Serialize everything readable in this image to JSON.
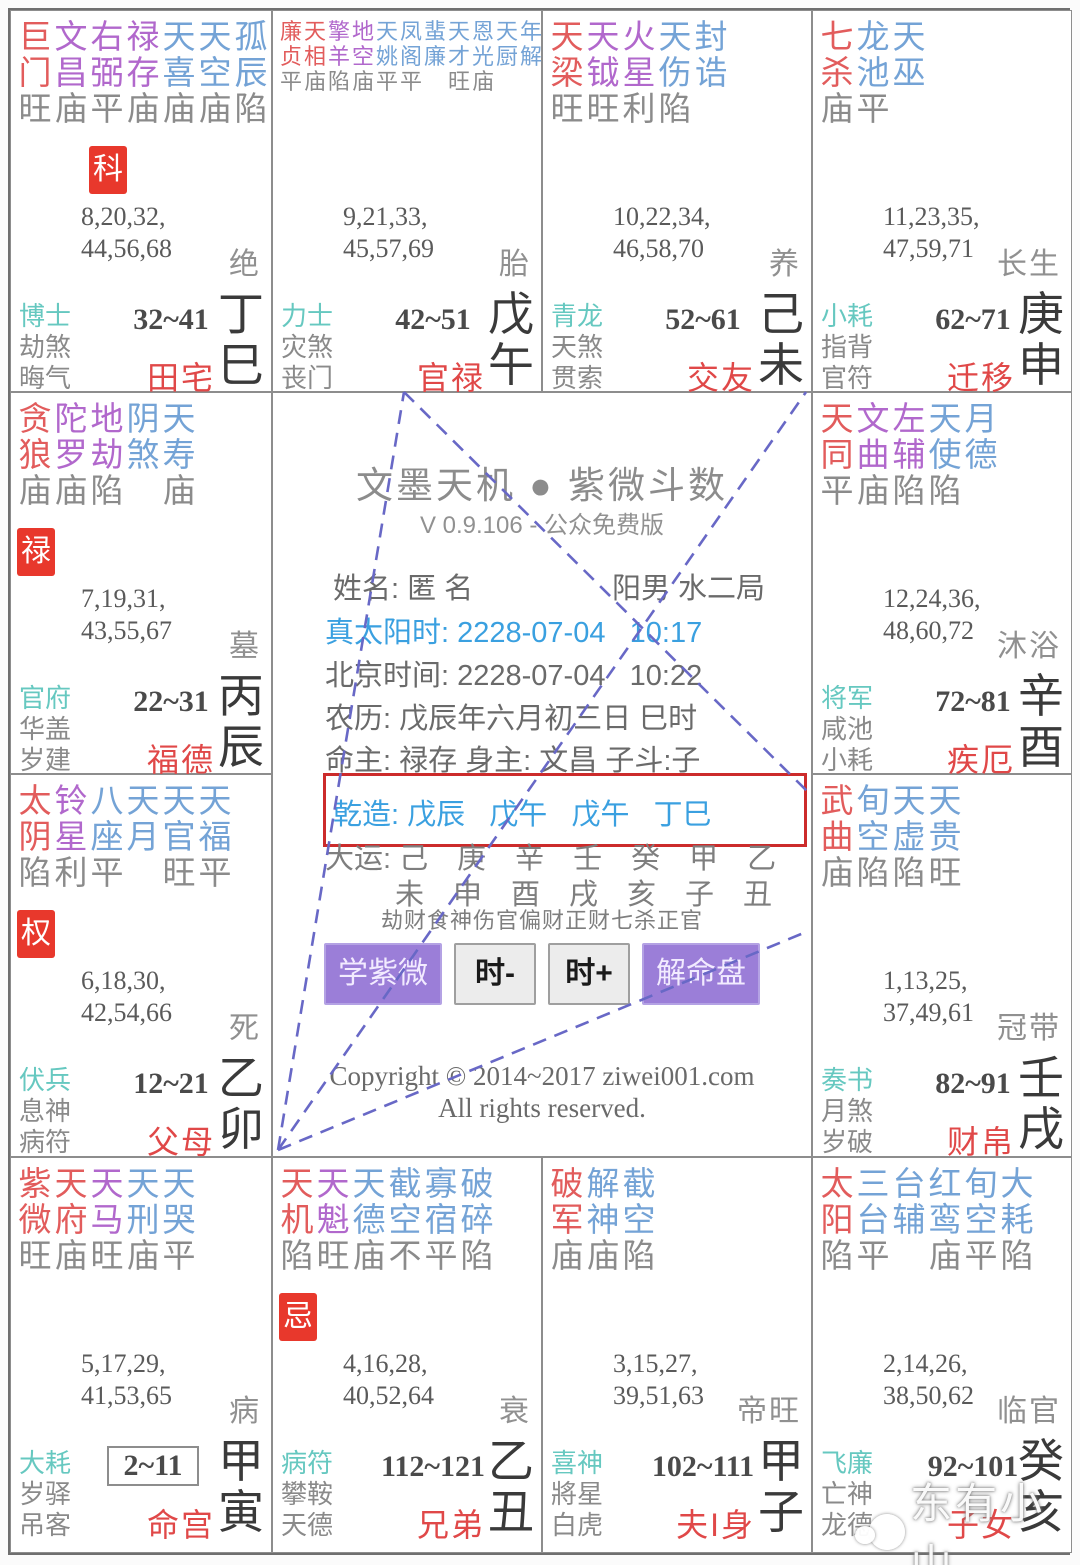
{
  "app": {
    "title": "文墨天机 ● 紫微斗数",
    "version": "V 0.9.106 - 公众免费版",
    "name_line": "姓名: 匿 名",
    "gender_bureau": "阳男 水二局",
    "true_solar_time": "真太阳时: 2228-07-04   10:17",
    "beijing_time": "北京时间: 2228-07-04   10:22",
    "lunar_date": "农历: 戊辰年六月初三日 巳时",
    "masters": "命主: 禄存 身主: 文昌 子斗:子",
    "qianzao": "乾造: 戊辰   戊午   戊午   丁巳",
    "dayun_stems": "大运: 己　庚　辛　壬　癸　甲　乙",
    "dayun_branches": "未　申　酉　戌　亥　子　丑",
    "ten_gods": "劫财食神伤官偏财正财七杀正官",
    "copyright_line1": "Copyright © 2014~2017 ziwei001.com",
    "copyright_line2": "All rights reserved.",
    "watermark": "东有小山",
    "accent_colors": {
      "major_star": "#e25c5c",
      "assist_star": "#b168cc",
      "minor_star": "#74a3d6",
      "badge_bg": "#e8382c",
      "palace_name": "#e04848",
      "god_teal": "#66c8c0",
      "highlight_box": "#cc2b2b",
      "time_blue": "#3aa0e0",
      "button_purple": "#9b7ed8",
      "dash_line": "#6868c6"
    },
    "buttons": [
      {
        "label": "学紫微",
        "kind": "purple"
      },
      {
        "label": "时-",
        "kind": "gray"
      },
      {
        "label": "时+",
        "kind": "gray"
      },
      {
        "label": "解命盘",
        "kind": "purple"
      }
    ]
  },
  "palaces": [
    {
      "slot": "r1c1",
      "branch_id": "si",
      "stars": [
        {
          "n": "巨门",
          "t": "m",
          "s": "旺"
        },
        {
          "n": "文昌",
          "t": "a",
          "s": "庙"
        },
        {
          "n": "右弼",
          "t": "a",
          "s": "平"
        },
        {
          "n": "禄存",
          "t": "a",
          "s": "庙"
        },
        {
          "n": "天喜",
          "t": "n",
          "s": "庙"
        },
        {
          "n": "天空",
          "t": "n",
          "s": "庙"
        },
        {
          "n": "孤辰",
          "t": "n",
          "s": "陷"
        }
      ],
      "badge": "科",
      "badge_col": 2,
      "ages1": "8,20,32,",
      "ages2": "44,56,68",
      "state": "绝",
      "gods": [
        "博士",
        "劫煞",
        "晦气"
      ],
      "range": "32~41",
      "boxed": false,
      "palace": "田宅",
      "stem": "丁",
      "branch": "巳"
    },
    {
      "slot": "r1c2",
      "branch_id": "wu",
      "stars": [
        {
          "n": "廉贞",
          "t": "m",
          "s": "平"
        },
        {
          "n": "天相",
          "t": "m",
          "s": "庙"
        },
        {
          "n": "擎羊",
          "t": "a",
          "s": "陷"
        },
        {
          "n": "地空",
          "t": "a",
          "s": "庙"
        },
        {
          "n": "天姚",
          "t": "n",
          "s": "平"
        },
        {
          "n": "凤阁",
          "t": "n",
          "s": "平"
        },
        {
          "n": "蜚廉",
          "t": "n",
          "s": ""
        },
        {
          "n": "天才",
          "t": "n",
          "s": "旺"
        },
        {
          "n": "恩光",
          "t": "n",
          "s": "庙"
        },
        {
          "n": "天厨",
          "t": "n",
          "s": ""
        },
        {
          "n": "年解",
          "t": "n",
          "s": ""
        }
      ],
      "badge": "",
      "badge_col": 0,
      "ages1": "9,21,33,",
      "ages2": "45,57,69",
      "state": "胎",
      "gods": [
        "力士",
        "灾煞",
        "丧门"
      ],
      "range": "42~51",
      "boxed": false,
      "palace": "官禄",
      "stem": "戊",
      "branch": "午"
    },
    {
      "slot": "r1c3",
      "branch_id": "wei",
      "stars": [
        {
          "n": "天梁",
          "t": "m",
          "s": "旺"
        },
        {
          "n": "天钺",
          "t": "a",
          "s": "旺"
        },
        {
          "n": "火星",
          "t": "a",
          "s": "利"
        },
        {
          "n": "天伤",
          "t": "n",
          "s": "陷"
        },
        {
          "n": "封诰",
          "t": "n",
          "s": ""
        }
      ],
      "badge": "",
      "badge_col": 0,
      "ages1": "10,22,34,",
      "ages2": "46,58,70",
      "state": "养",
      "gods": [
        "青龙",
        "天煞",
        "贯索"
      ],
      "range": "52~61",
      "boxed": false,
      "palace": "交友",
      "stem": "己",
      "branch": "未"
    },
    {
      "slot": "r1c4",
      "branch_id": "shen",
      "stars": [
        {
          "n": "七杀",
          "t": "m",
          "s": "庙"
        },
        {
          "n": "龙池",
          "t": "n",
          "s": "平"
        },
        {
          "n": "天巫",
          "t": "n",
          "s": ""
        }
      ],
      "badge": "",
      "badge_col": 0,
      "ages1": "11,23,35,",
      "ages2": "47,59,71",
      "state": "长生",
      "gods": [
        "小耗",
        "指背",
        "官符"
      ],
      "range": "62~71",
      "boxed": false,
      "palace": "迁移",
      "stem": "庚",
      "branch": "申"
    },
    {
      "slot": "r2c1",
      "branch_id": "chen",
      "stars": [
        {
          "n": "贪狼",
          "t": "m",
          "s": "庙"
        },
        {
          "n": "陀罗",
          "t": "a",
          "s": "庙"
        },
        {
          "n": "地劫",
          "t": "a",
          "s": "陷"
        },
        {
          "n": "阴煞",
          "t": "n",
          "s": ""
        },
        {
          "n": "天寿",
          "t": "n",
          "s": "庙"
        }
      ],
      "badge": "禄",
      "badge_col": 0,
      "ages1": "7,19,31,",
      "ages2": "43,55,67",
      "state": "墓",
      "gods": [
        "官府",
        "华盖",
        "岁建"
      ],
      "range": "22~31",
      "boxed": false,
      "palace": "福德",
      "stem": "丙",
      "branch": "辰"
    },
    {
      "slot": "r2c4",
      "branch_id": "you",
      "stars": [
        {
          "n": "天同",
          "t": "m",
          "s": "平"
        },
        {
          "n": "文曲",
          "t": "a",
          "s": "庙"
        },
        {
          "n": "左辅",
          "t": "a",
          "s": "陷"
        },
        {
          "n": "天使",
          "t": "n",
          "s": "陷"
        },
        {
          "n": "月德",
          "t": "n",
          "s": ""
        }
      ],
      "badge": "",
      "badge_col": 0,
      "ages1": "12,24,36,",
      "ages2": "48,60,72",
      "state": "沐浴",
      "gods": [
        "将军",
        "咸池",
        "小耗"
      ],
      "range": "72~81",
      "boxed": false,
      "palace": "疾厄",
      "stem": "辛",
      "branch": "酉"
    },
    {
      "slot": "r3c1",
      "branch_id": "mao",
      "stars": [
        {
          "n": "太阴",
          "t": "m",
          "s": "陷"
        },
        {
          "n": "铃星",
          "t": "a",
          "s": "利"
        },
        {
          "n": "八座",
          "t": "n",
          "s": "平"
        },
        {
          "n": "天月",
          "t": "n",
          "s": ""
        },
        {
          "n": "天官",
          "t": "n",
          "s": "旺"
        },
        {
          "n": "天福",
          "t": "n",
          "s": "平"
        }
      ],
      "badge": "权",
      "badge_col": 0,
      "ages1": "6,18,30,",
      "ages2": "42,54,66",
      "state": "死",
      "gods": [
        "伏兵",
        "息神",
        "病符"
      ],
      "range": "12~21",
      "boxed": false,
      "palace": "父母",
      "stem": "乙",
      "branch": "卯"
    },
    {
      "slot": "r3c4",
      "branch_id": "xu",
      "stars": [
        {
          "n": "武曲",
          "t": "m",
          "s": "庙"
        },
        {
          "n": "旬空",
          "t": "n",
          "s": "陷"
        },
        {
          "n": "天虚",
          "t": "n",
          "s": "陷"
        },
        {
          "n": "天贵",
          "t": "n",
          "s": "旺"
        }
      ],
      "badge": "",
      "badge_col": 0,
      "ages1": "1,13,25,",
      "ages2": "37,49,61",
      "state": "冠带",
      "gods": [
        "奏书",
        "月煞",
        "岁破"
      ],
      "range": "82~91",
      "boxed": false,
      "palace": "财帛",
      "stem": "壬",
      "branch": "戌"
    },
    {
      "slot": "r4c1",
      "branch_id": "yin",
      "stars": [
        {
          "n": "紫微",
          "t": "m",
          "s": "旺"
        },
        {
          "n": "天府",
          "t": "m",
          "s": "庙"
        },
        {
          "n": "天马",
          "t": "a",
          "s": "旺"
        },
        {
          "n": "天刑",
          "t": "n",
          "s": "庙"
        },
        {
          "n": "天哭",
          "t": "n",
          "s": "平"
        }
      ],
      "badge": "",
      "badge_col": 0,
      "ages1": "5,17,29,",
      "ages2": "41,53,65",
      "state": "病",
      "gods": [
        "大耗",
        "岁驿",
        "吊客"
      ],
      "range": "2~11",
      "boxed": true,
      "palace": "命宫",
      "stem": "甲",
      "branch": "寅"
    },
    {
      "slot": "r4c2",
      "branch_id": "chou",
      "stars": [
        {
          "n": "天机",
          "t": "m",
          "s": "陷"
        },
        {
          "n": "天魁",
          "t": "a",
          "s": "旺"
        },
        {
          "n": "天德",
          "t": "n",
          "s": "庙"
        },
        {
          "n": "截空",
          "t": "n",
          "s": "不"
        },
        {
          "n": "寡宿",
          "t": "n",
          "s": "平"
        },
        {
          "n": "破碎",
          "t": "n",
          "s": "陷"
        }
      ],
      "badge": "忌",
      "badge_col": 0,
      "ages1": "4,16,28,",
      "ages2": "40,52,64",
      "state": "衰",
      "gods": [
        "病符",
        "攀鞍",
        "天德"
      ],
      "range": "112~121",
      "boxed": false,
      "palace": "兄弟",
      "stem": "乙",
      "branch": "丑"
    },
    {
      "slot": "r4c3",
      "branch_id": "zi",
      "stars": [
        {
          "n": "破军",
          "t": "m",
          "s": "庙"
        },
        {
          "n": "解神",
          "t": "n",
          "s": "庙"
        },
        {
          "n": "截空",
          "t": "n",
          "s": "陷"
        }
      ],
      "badge": "",
      "badge_col": 0,
      "ages1": "3,15,27,",
      "ages2": "39,51,63",
      "state": "帝旺",
      "gods": [
        "喜神",
        "將星",
        "白虎"
      ],
      "range": "102~111",
      "boxed": false,
      "palace": "夫I身",
      "stem": "甲",
      "branch": "子"
    },
    {
      "slot": "r4c4",
      "branch_id": "hai",
      "stars": [
        {
          "n": "太阳",
          "t": "m",
          "s": "陷"
        },
        {
          "n": "三台",
          "t": "n",
          "s": "平"
        },
        {
          "n": "台辅",
          "t": "n",
          "s": ""
        },
        {
          "n": "红鸾",
          "t": "n",
          "s": "庙"
        },
        {
          "n": "旬空",
          "t": "n",
          "s": "平"
        },
        {
          "n": "大耗",
          "t": "n",
          "s": "陷"
        }
      ],
      "badge": "",
      "badge_col": 0,
      "ages1": "2,14,26,",
      "ages2": "38,50,62",
      "state": "临官",
      "gods": [
        "飞廉",
        "亡神",
        "龙德"
      ],
      "range": "92~101",
      "boxed": false,
      "palace": "子女",
      "stem": "癸",
      "branch": "亥"
    }
  ]
}
